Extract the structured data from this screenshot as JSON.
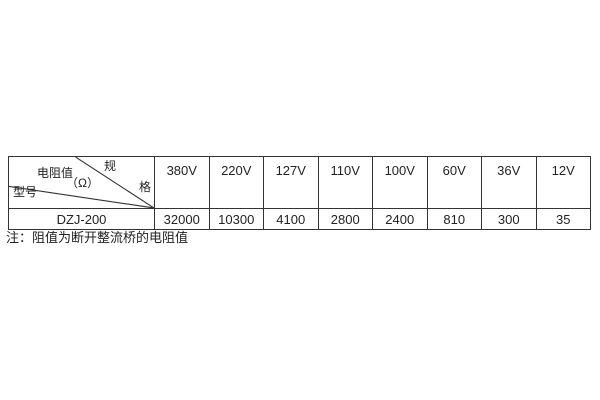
{
  "table": {
    "corner": {
      "spec_top": "规",
      "spec_bottom": "格",
      "value_label": "电阻值",
      "value_unit": "（Ω）",
      "model_label": "型号"
    },
    "columns": [
      "380V",
      "220V",
      "127V",
      "110V",
      "100V",
      "60V",
      "36V",
      "12V"
    ],
    "rows": [
      {
        "model": "DZJ-200",
        "values": [
          "32000",
          "10300",
          "4100",
          "2800",
          "2400",
          "810",
          "300",
          "35"
        ]
      }
    ]
  },
  "note": "注：阻值为断开整流桥的电阻值",
  "colors": {
    "border": "#333333",
    "text": "#222222",
    "background": "#ffffff"
  }
}
